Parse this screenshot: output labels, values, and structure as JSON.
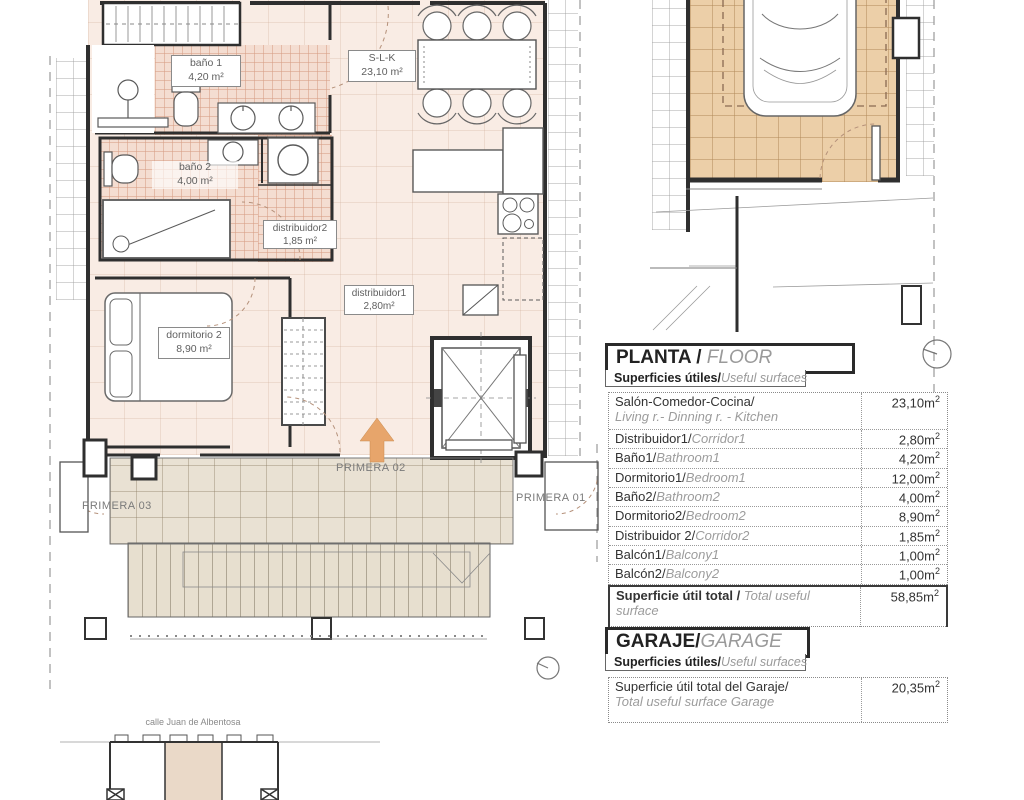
{
  "plan": {
    "rooms": {
      "bano1": {
        "name": "baño 1",
        "area": "4,20 m²"
      },
      "slk": {
        "name": "S-L-K",
        "area": "23,10 m²"
      },
      "bano2": {
        "name": "baño 2",
        "area": "4,00 m²"
      },
      "distribuidor2": {
        "name": "distribuidor2",
        "area": "1,85 m²"
      },
      "dormitorio2": {
        "name": "dormitorio 2",
        "area": "8,90 m²"
      },
      "distribuidor1": {
        "name": "distribuidor1",
        "area": "2,80m²"
      }
    },
    "zones": {
      "primera01": "PRIMERA 01",
      "primera02": "PRIMERA 02",
      "primera03": "PRIMERA 03"
    },
    "street": "calle Juan de Albentosa"
  },
  "floor_table": {
    "title_es": "PLANTA / ",
    "title_en": "FLOOR",
    "subtitle_es": "Superficies útiles/",
    "subtitle_en": "Useful surfaces",
    "rows": [
      {
        "es": "Salón-Comedor-Cocina/",
        "en": "Living r.- Dinning r. - Kitchen",
        "val": "23,10m",
        "sup": "2"
      },
      {
        "es": "Distribuidor1/",
        "en": "Corridor1",
        "val": "2,80m",
        "sup": "2"
      },
      {
        "es": "Baño1/",
        "en": "Bathroom1",
        "val": "4,20m",
        "sup": "2"
      },
      {
        "es": "Dormitorio1/",
        "en": "Bedroom1",
        "val": "12,00m",
        "sup": "2"
      },
      {
        "es": "Baño2/",
        "en": "Bathroom2",
        "val": "4,00m",
        "sup": "2"
      },
      {
        "es": "Dormitorio2/",
        "en": "Bedroom2",
        "val": "8,90m",
        "sup": "2"
      },
      {
        "es": "Distribuidor 2/",
        "en": "Corridor2",
        "val": "1,85m",
        "sup": "2"
      },
      {
        "es": "Balcón1/",
        "en": "Balcony1",
        "val": "1,00m",
        "sup": "2"
      },
      {
        "es": "Balcón2/",
        "en": "Balcony2",
        "val": "1,00m",
        "sup": "2"
      }
    ],
    "total": {
      "es": "Superficie útil total / ",
      "en": "Total useful surface",
      "val": "58,85m",
      "sup": "2"
    }
  },
  "garage_table": {
    "title_es": "GARAJE/",
    "title_en": "GARAGE",
    "subtitle_es": "Superficies útiles/",
    "subtitle_en": "Useful surfaces",
    "row": {
      "es": "Superficie útil total del Garaje/",
      "en": "Total useful surface Garage",
      "val": "20,35m",
      "sup": "2"
    }
  },
  "colors": {
    "wall": "#2f2f2f",
    "bath_tile": "#f4ddd1",
    "garage_floor": "#eccfa8",
    "terrace_tile": "#e9e1d3",
    "arrow_accent": "#e7a56b"
  }
}
